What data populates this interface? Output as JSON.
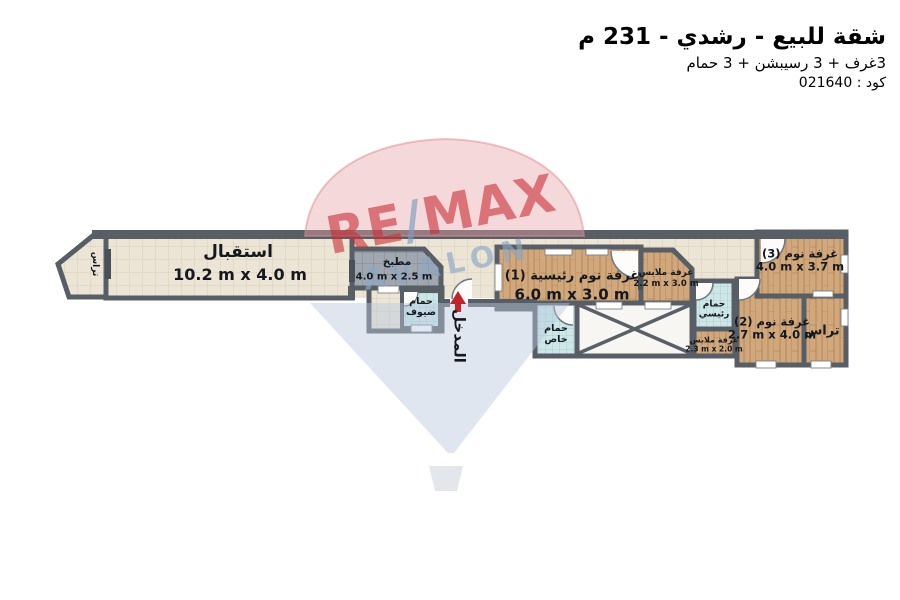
{
  "header": {
    "title": "شقة للبيع - رشدي - 231 م",
    "subtitle": "3غرف + 3 رسيبشن + 3 حمام",
    "code": "كود : 021640"
  },
  "watermark": {
    "re": "RE",
    "slash": "/",
    "max": "MAX",
    "sub": "AVALON"
  },
  "entrance": {
    "label": "المدخل"
  },
  "rooms": {
    "reception": {
      "name": "استقبال",
      "dims": "10.2 m x 4.0 m"
    },
    "kitchen": {
      "name": "مطبخ",
      "dims": "4.0 m x 2.5 m"
    },
    "guest_bath": {
      "name": "حمام\nضيوف"
    },
    "master_bedroom": {
      "name": "غرفة نوم رئيسية (1)",
      "dims": "6.0 m x 3.0 m"
    },
    "dressing_1": {
      "name": "غرفة ملابس",
      "dims": "2.2 m x 3.0 m"
    },
    "private_bath": {
      "name": "حمام\nخاص"
    },
    "master_bath": {
      "name": "حمام\nرئيسي"
    },
    "dressing_2": {
      "name": "غرفة ملابس",
      "dims": "2.3 m x 2.0 m"
    },
    "bedroom_2": {
      "name": "غرفة نوم (2)",
      "dims": "2.7 m x 4.0 m"
    },
    "bedroom_3": {
      "name": "غرفة نوم (3)",
      "dims": "4.0 m x 3.7 m"
    },
    "terrace_left": {
      "name": "تراس"
    },
    "terrace_right": {
      "name": "تراس"
    }
  },
  "colors": {
    "wall": "#585e66",
    "floor_cream": "#ece5d5",
    "floor_gray": "#a0a7b0",
    "floor_blue": "#cde7e9",
    "floor_wood": "#d1a87c",
    "entrance_arrow": "#c4232b",
    "brand_red": "#c92f36",
    "brand_blue": "#8ba6c6"
  }
}
